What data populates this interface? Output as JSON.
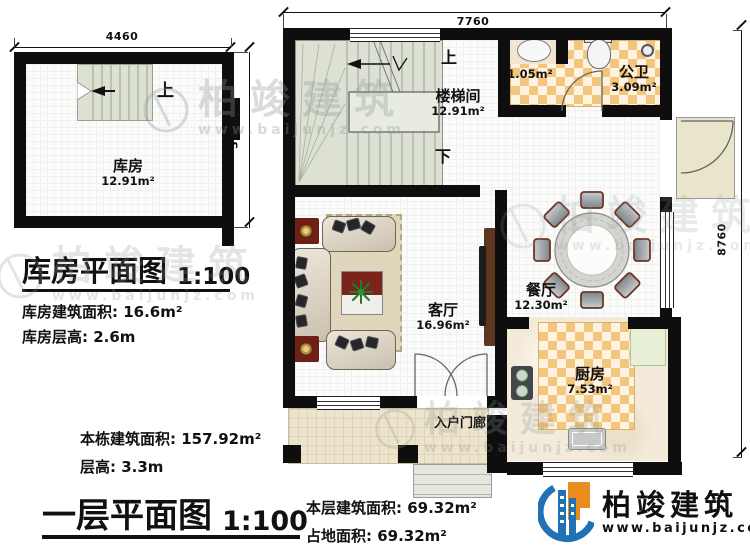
{
  "sheet": {
    "background": "#ffffff",
    "wall_color": "#0e0e0e",
    "checker_color": "#f2c77d",
    "stair_color": "#dce1d3"
  },
  "storage_plan": {
    "title": "库房平面图",
    "scale": "1:100",
    "dim_top": "4460",
    "dim_right": "3300",
    "up_label": "上",
    "room_name": "库房",
    "room_area": "12.91m²",
    "area_note_label": "库房建筑面积:",
    "area_note_value": "16.6m²",
    "height_note_label": "库房层高:",
    "height_note_value": "2.6m"
  },
  "first_floor_plan": {
    "title": "一层平面图",
    "scale": "1:100",
    "dim_top": "7760",
    "dim_right": "8760",
    "up_label": "上",
    "down_label": "下",
    "rooms": {
      "stairwell": {
        "name": "楼梯间",
        "area": "12.91m²"
      },
      "toilet": {
        "name": "公卫",
        "area": "3.09m²"
      },
      "washroom": {
        "area": "1.05m²"
      },
      "dining": {
        "name": "餐厅",
        "area": "12.30m²"
      },
      "living": {
        "name": "客厅",
        "area": "16.96m²"
      },
      "kitchen": {
        "name": "厨房",
        "area": "7.53m²"
      },
      "porch": {
        "name": "入户门廊"
      }
    },
    "building_area_label": "本栋建筑面积:",
    "building_area_value": "157.92m²",
    "floor_height_label": "层高:",
    "floor_height_value": "3.3m",
    "level_area_label": "本层建筑面积:",
    "level_area_value": "69.32m²",
    "footprint_label": "占地面积:",
    "footprint_value": "69.32m²"
  },
  "branding": {
    "company": "柏竣建筑",
    "website": "www.baijunjz.com",
    "blue": "#2371b5",
    "orange": "#ea8c1e"
  },
  "watermark": {
    "company": "柏竣建筑",
    "website": "www.baijunjz.com"
  }
}
